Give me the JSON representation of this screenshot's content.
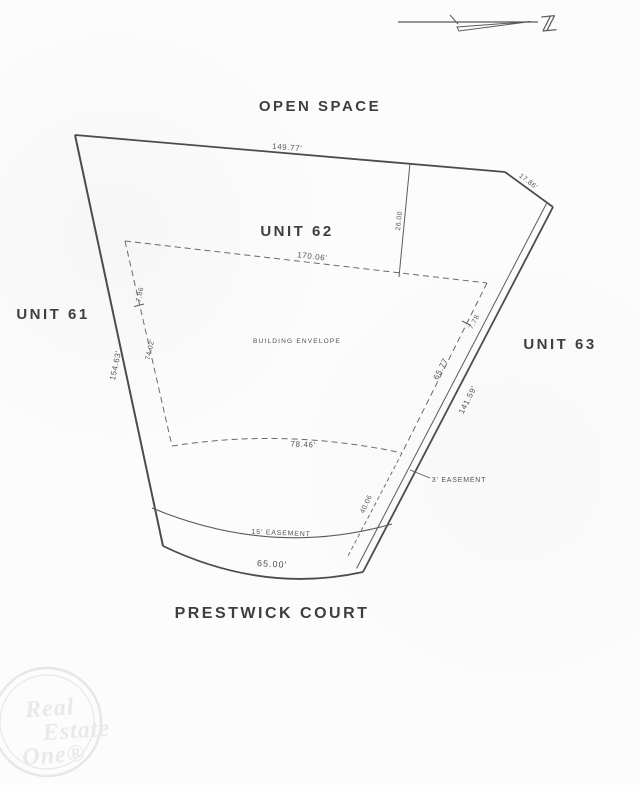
{
  "document": {
    "type": "condominium-unit-site-plan",
    "ink_color": "#5a5a5a",
    "paper_color": "#fcfcfc"
  },
  "north": {
    "symbol": "ℤ"
  },
  "areas": {
    "open_space": "OPEN SPACE",
    "unit_61": "UNIT 61",
    "unit_62": "UNIT 62",
    "unit_63": "UNIT 63",
    "street": "PRESTWICK COURT",
    "building_envelope": "BUILDING ENVELOPE"
  },
  "dimensions": {
    "top_boundary": "149.77'",
    "top_right_corner": "17.86'",
    "top_offset": "26.00",
    "envelope_top": "170.06'",
    "envelope_left_upper": "7.86",
    "envelope_left": "74.02'",
    "left_boundary": "154.63'",
    "envelope_right_upper": "7.78",
    "envelope_right": "65.77",
    "right_boundary": "141.59'",
    "envelope_bottom": "78.46'",
    "bottom_offset": "40.06",
    "frontage": "65.00'"
  },
  "easements": {
    "side": "3' EASEMENT",
    "front": "15' EASEMENT"
  },
  "watermark": {
    "line1": "Real",
    "line2": "Estate",
    "line3": "One®"
  }
}
